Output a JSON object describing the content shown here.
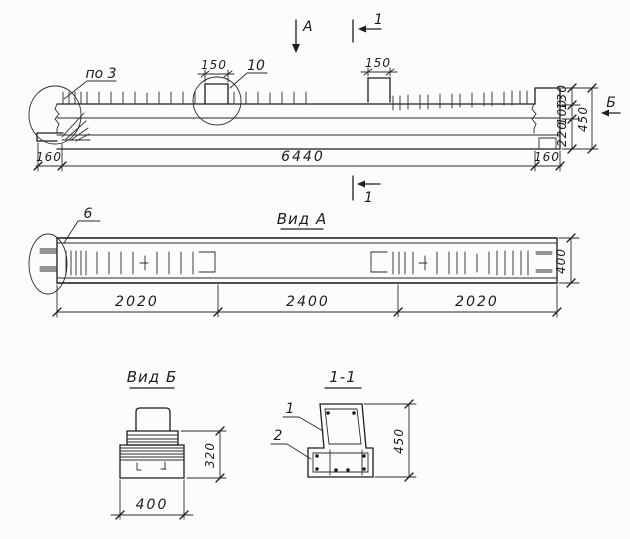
{
  "colors": {
    "ink": "#1d1d1d",
    "paper": "#fcfcfa"
  },
  "elevation": {
    "view_direction_label": "А",
    "section_cut_label": "1",
    "detail_callout_left": "по 3",
    "detail_callout_notch": "10",
    "side_view_label": "Б",
    "dims": {
      "notch1_width": "150",
      "notch2_width": "150",
      "left_overhang": "160",
      "total_length": "6440",
      "right_overhang": "160",
      "top_step": "130",
      "upper_part": "100",
      "total_height": "450",
      "bottom_part": "220"
    }
  },
  "view_a": {
    "title": "Вид А",
    "detail_callout": "6",
    "dims": {
      "left_zone": "2020",
      "middle_zone": "2400",
      "right_zone": "2020",
      "width": "400"
    }
  },
  "view_b": {
    "title": "Вид Б",
    "dims": {
      "height": "320",
      "width": "400"
    }
  },
  "section_1_1": {
    "title": "1-1",
    "callout_top": "1",
    "callout_bottom": "2",
    "dims": {
      "height": "450"
    }
  }
}
